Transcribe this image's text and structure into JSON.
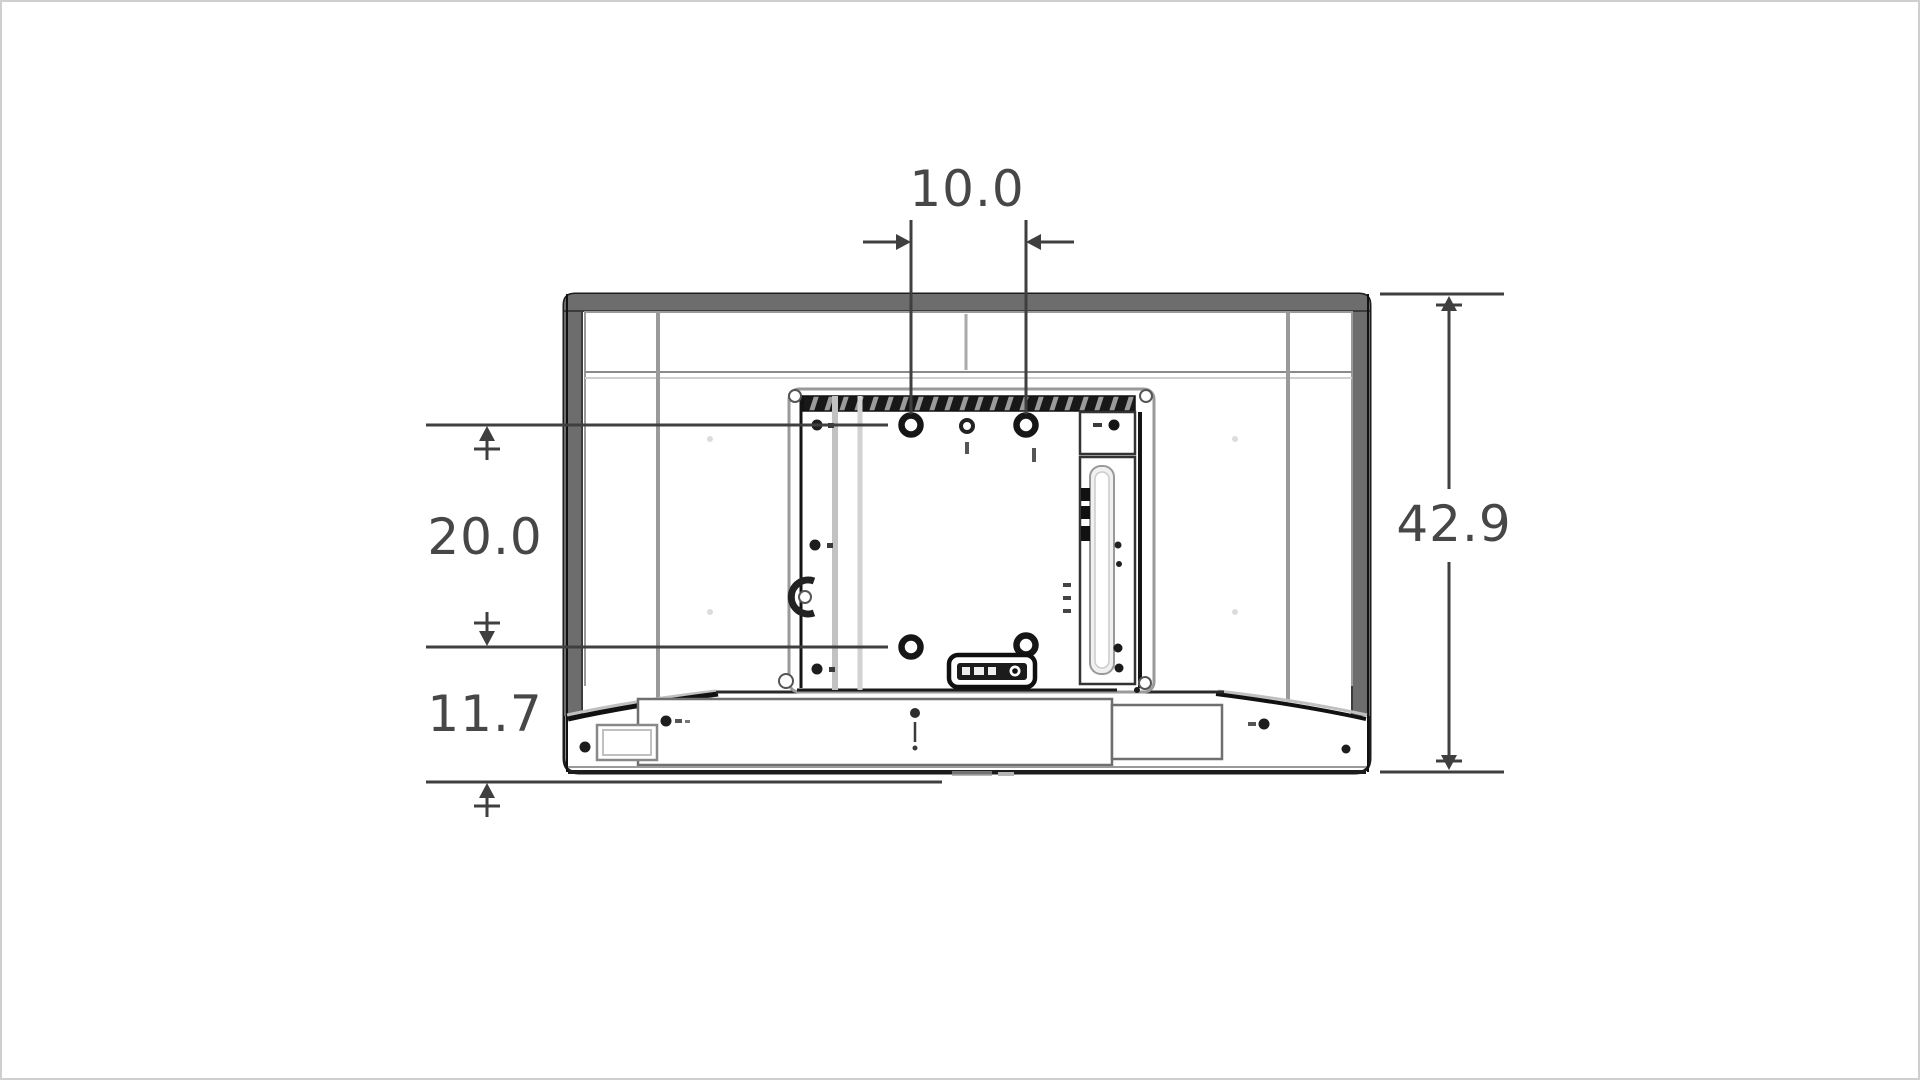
{
  "diagram": {
    "type": "tv-rear-vesa-mount-dimension-drawing",
    "labels": {
      "hole_spacing_width": "10.0",
      "hole_spacing_height": "20.0",
      "bottom_to_lower_holes": "11.7",
      "overall_height": "42.9"
    },
    "colors": {
      "dimension_line": "#3f3f3f",
      "bezel_gray": "#6d6d6d",
      "outline_black": "#1c1c1c"
    }
  }
}
